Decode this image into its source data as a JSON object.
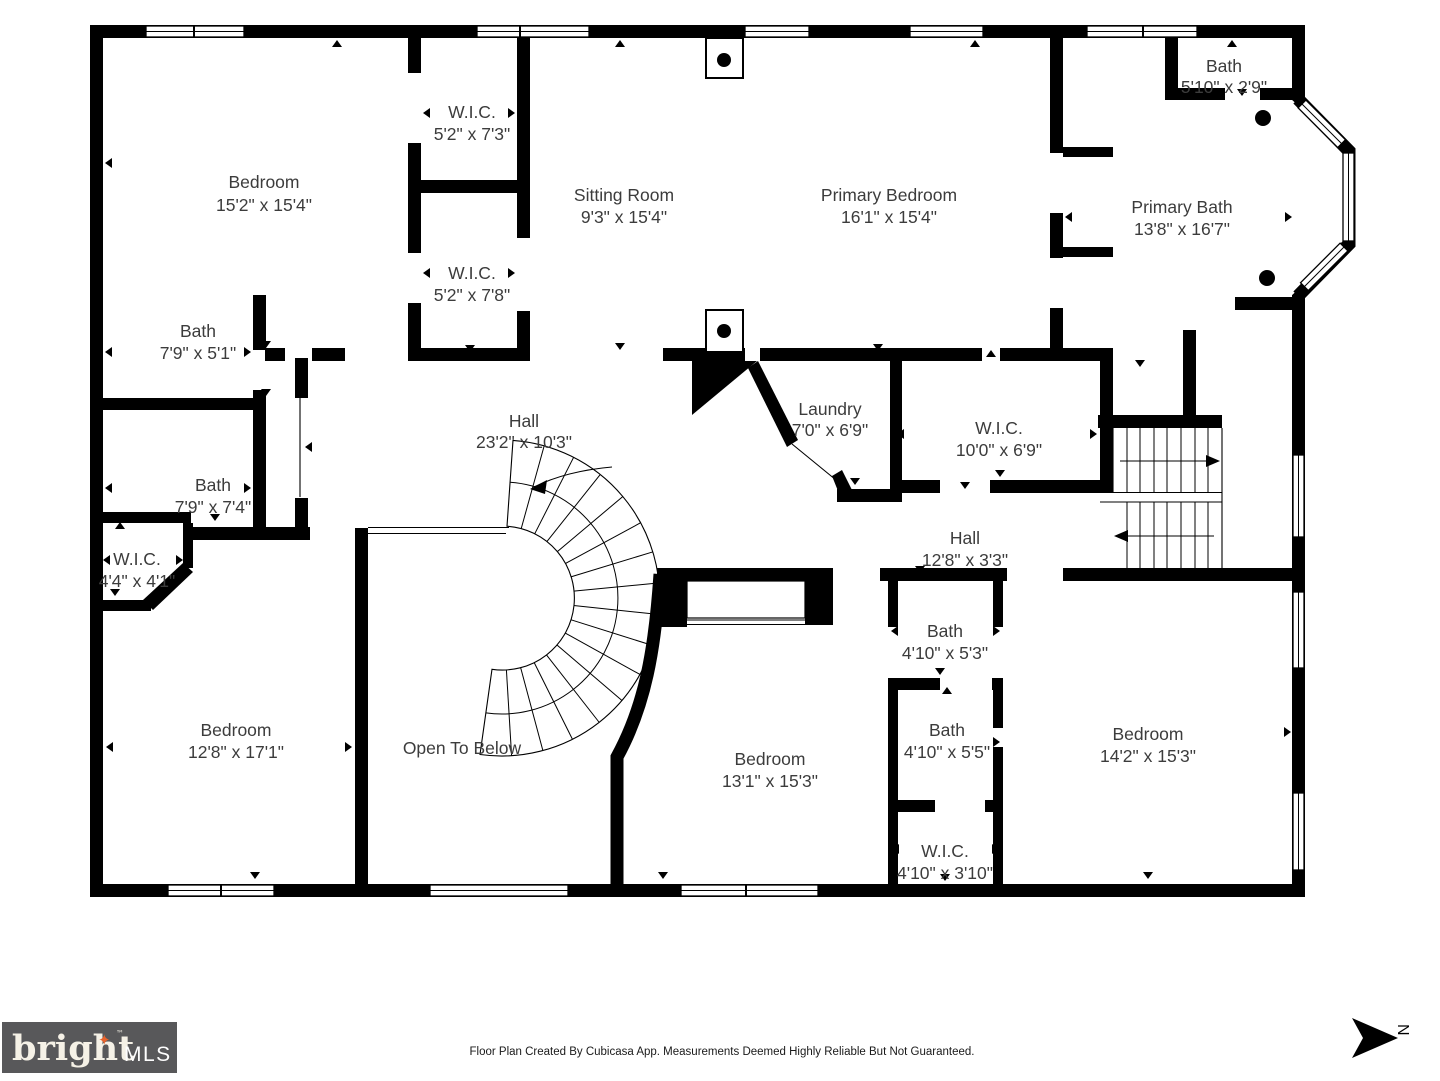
{
  "rooms": {
    "bedroom_tl": {
      "name": "Bedroom",
      "dims": "15'2\" x 15'4\""
    },
    "wic_tl_upper": {
      "name": "W.I.C.",
      "dims": "5'2\" x 7'3\""
    },
    "wic_tl_lower": {
      "name": "W.I.C.",
      "dims": "5'2\" x 7'8\""
    },
    "sitting_room": {
      "name": "Sitting Room",
      "dims": "9'3\" x 15'4\""
    },
    "primary_bedroom": {
      "name": "Primary Bedroom",
      "dims": "16'1\" x 15'4\""
    },
    "bath_top_right": {
      "name": "Bath",
      "dims": "5'10\" x 2'9\""
    },
    "primary_bath": {
      "name": "Primary Bath",
      "dims": "13'8\" x 16'7\""
    },
    "bath_mid_left_upper": {
      "name": "Bath",
      "dims": "7'9\" x 5'1\""
    },
    "bath_mid_left_lower": {
      "name": "Bath",
      "dims": "7'9\" x 7'4\""
    },
    "wic_mid_left": {
      "name": "W.I.C.",
      "dims": "4'4\" x 4'1\""
    },
    "hall_main": {
      "name": "Hall",
      "dims": "23'2\" x 10'3\""
    },
    "laundry": {
      "name": "Laundry",
      "dims": "7'0\" x 6'9\""
    },
    "wic_center": {
      "name": "W.I.C.",
      "dims": "10'0\" x 6'9\""
    },
    "hall_small": {
      "name": "Hall",
      "dims": "12'8\" x 3'3\""
    },
    "bedroom_bottom_left": {
      "name": "Bedroom",
      "dims": "12'8\" x 17'1\""
    },
    "open_to_below": {
      "name": "Open To Below"
    },
    "bedroom_bottom_mid": {
      "name": "Bedroom",
      "dims": "13'1\" x 15'3\""
    },
    "bath_center_upper": {
      "name": "Bath",
      "dims": "4'10\" x 5'3\""
    },
    "bath_center_lower": {
      "name": "Bath",
      "dims": "4'10\" x 5'5\""
    },
    "wic_bottom_mid": {
      "name": "W.I.C.",
      "dims": "4'10\" x 3'10\""
    },
    "bedroom_bottom_right": {
      "name": "Bedroom",
      "dims": "14'2\" x 15'3\""
    }
  },
  "footer": {
    "disclaimer": "Floor Plan Created By Cubicasa App. Measurements Deemed Highly Reliable But Not Guaranteed."
  },
  "logo": {
    "brand": "bright",
    "star": "✦",
    "tm": "™",
    "suffix": "MLS"
  },
  "compass": {
    "north_label": "N"
  },
  "colors": {
    "wall": "#000000",
    "background": "#ffffff",
    "label_text": "#3c3c3c",
    "logo_background": "#58585a",
    "logo_text": "#f5f1e6",
    "logo_star": "#e8632c"
  }
}
